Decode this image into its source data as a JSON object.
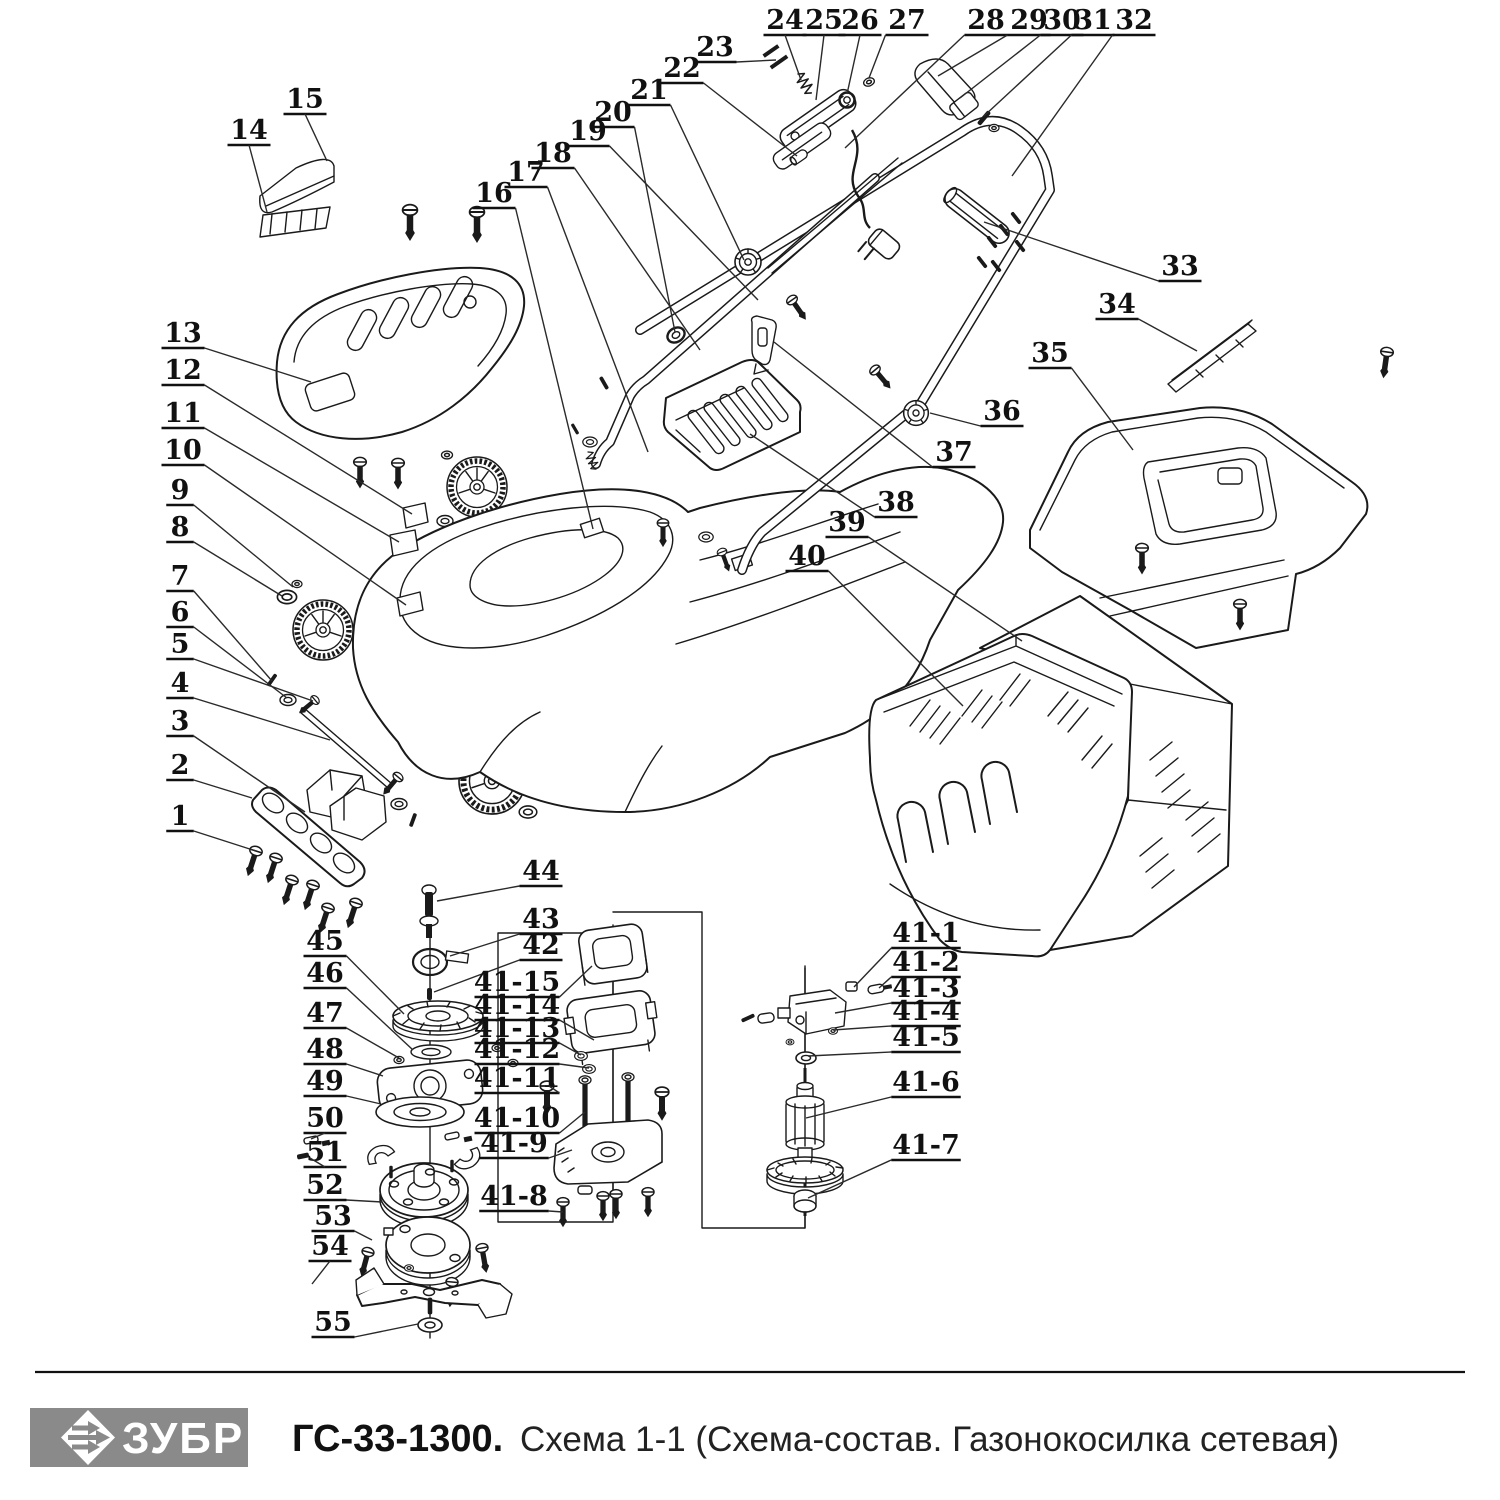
{
  "footer": {
    "brand": "ЗУБР",
    "model": "ГС-33-1300.",
    "title": "Схема 1-1 (Схема-состав. Газонокосилка сетевая)",
    "logo_bg": "#8a8a8a",
    "logo_text_color": "#ffffff"
  },
  "diagram": {
    "line_color": "#1a1a1a",
    "labels": [
      {
        "id": "1",
        "x": 180,
        "y": 816,
        "tx": 256,
        "ty": 851
      },
      {
        "id": "2",
        "x": 180,
        "y": 765,
        "tx": 252,
        "ty": 798
      },
      {
        "id": "3",
        "x": 180,
        "y": 721,
        "tx": 305,
        "ty": 812
      },
      {
        "id": "4",
        "x": 180,
        "y": 683,
        "tx": 330,
        "ty": 740
      },
      {
        "id": "5",
        "x": 180,
        "y": 644,
        "tx": 313,
        "ty": 701
      },
      {
        "id": "6",
        "x": 180,
        "y": 612,
        "tx": 287,
        "ty": 698
      },
      {
        "id": "7",
        "x": 180,
        "y": 576,
        "tx": 272,
        "ty": 681
      },
      {
        "id": "8",
        "x": 180,
        "y": 527,
        "tx": 282,
        "ty": 596
      },
      {
        "id": "9",
        "x": 180,
        "y": 490,
        "tx": 293,
        "ty": 587
      },
      {
        "id": "10",
        "x": 183,
        "y": 450,
        "tx": 406,
        "ty": 605
      },
      {
        "id": "11",
        "x": 183,
        "y": 413,
        "tx": 399,
        "ty": 542
      },
      {
        "id": "12",
        "x": 183,
        "y": 370,
        "tx": 412,
        "ty": 514
      },
      {
        "id": "13",
        "x": 183,
        "y": 333,
        "tx": 311,
        "ty": 382
      },
      {
        "id": "14",
        "x": 249,
        "y": 130,
        "tx": 267,
        "ty": 212
      },
      {
        "id": "15",
        "x": 305,
        "y": 99,
        "tx": 327,
        "ty": 161
      },
      {
        "id": "16",
        "x": 494,
        "y": 193,
        "tx": 593,
        "ty": 529
      },
      {
        "id": "17",
        "x": 526,
        "y": 172,
        "tx": 648,
        "ty": 452
      },
      {
        "id": "18",
        "x": 553,
        "y": 153,
        "tx": 700,
        "ty": 350
      },
      {
        "id": "19",
        "x": 588,
        "y": 131,
        "tx": 758,
        "ty": 300
      },
      {
        "id": "20",
        "x": 613,
        "y": 112,
        "tx": 675,
        "ty": 332
      },
      {
        "id": "21",
        "x": 649,
        "y": 90,
        "tx": 744,
        "ty": 260
      },
      {
        "id": "22",
        "x": 682,
        "y": 68,
        "tx": 797,
        "ty": 156
      },
      {
        "id": "23",
        "x": 715,
        "y": 47,
        "tx": 776,
        "ty": 60
      },
      {
        "id": "24",
        "x": 785,
        "y": 20,
        "tx": 801,
        "ty": 80
      },
      {
        "id": "25",
        "x": 824,
        "y": 20,
        "tx": 816,
        "ty": 100
      },
      {
        "id": "26",
        "x": 860,
        "y": 20,
        "tx": 847,
        "ty": 94
      },
      {
        "id": "27",
        "x": 907,
        "y": 20,
        "tx": 869,
        "ty": 78
      },
      {
        "id": "28",
        "x": 986,
        "y": 20,
        "tx": 845,
        "ty": 148
      },
      {
        "id": "29",
        "x": 1029,
        "y": 20,
        "tx": 938,
        "ty": 76
      },
      {
        "id": "30",
        "x": 1062,
        "y": 20,
        "tx": 960,
        "ty": 98
      },
      {
        "id": "31",
        "x": 1093,
        "y": 20,
        "tx": 984,
        "ty": 116
      },
      {
        "id": "32",
        "x": 1134,
        "y": 20,
        "tx": 1012,
        "ty": 176
      },
      {
        "id": "33",
        "x": 1180,
        "y": 266,
        "tx": 984,
        "ty": 222
      },
      {
        "id": "34",
        "x": 1117,
        "y": 304,
        "tx": 1197,
        "ty": 351
      },
      {
        "id": "35",
        "x": 1050,
        "y": 353,
        "tx": 1133,
        "ty": 450
      },
      {
        "id": "36",
        "x": 1002,
        "y": 411,
        "tx": 930,
        "ty": 413
      },
      {
        "id": "37",
        "x": 954,
        "y": 452,
        "tx": 774,
        "ty": 342
      },
      {
        "id": "38",
        "x": 896,
        "y": 502,
        "tx": 750,
        "ty": 434
      },
      {
        "id": "39",
        "x": 847,
        "y": 522,
        "tx": 1022,
        "ty": 641
      },
      {
        "id": "40",
        "x": 807,
        "y": 556,
        "tx": 963,
        "ty": 706
      },
      {
        "id": "44",
        "x": 541,
        "y": 871,
        "tx": 437,
        "ty": 901
      },
      {
        "id": "43",
        "x": 541,
        "y": 919,
        "tx": 450,
        "ty": 956
      },
      {
        "id": "42",
        "x": 541,
        "y": 945,
        "tx": 434,
        "ty": 992
      },
      {
        "id": "45",
        "x": 325,
        "y": 941,
        "tx": 404,
        "ty": 1014
      },
      {
        "id": "46",
        "x": 325,
        "y": 973,
        "tx": 413,
        "ty": 1050
      },
      {
        "id": "47",
        "x": 325,
        "y": 1013,
        "tx": 399,
        "ty": 1058
      },
      {
        "id": "48",
        "x": 325,
        "y": 1049,
        "tx": 383,
        "ty": 1076
      },
      {
        "id": "49",
        "x": 325,
        "y": 1081,
        "tx": 381,
        "ty": 1104
      },
      {
        "id": "50",
        "x": 325,
        "y": 1118,
        "tx": 311,
        "ty": 1139
      },
      {
        "id": "51",
        "x": 325,
        "y": 1152,
        "tx": 310,
        "ty": 1158
      },
      {
        "id": "52",
        "x": 325,
        "y": 1185,
        "tx": 382,
        "ty": 1202
      },
      {
        "id": "53",
        "x": 333,
        "y": 1216,
        "tx": 372,
        "ty": 1240
      },
      {
        "id": "54",
        "x": 330,
        "y": 1246,
        "tx": 312,
        "ty": 1284
      },
      {
        "id": "55",
        "x": 333,
        "y": 1322,
        "tx": 418,
        "ty": 1324
      },
      {
        "id": "41-15",
        "x": 517,
        "y": 982,
        "tx": 592,
        "ty": 966
      },
      {
        "id": "41-14",
        "x": 517,
        "y": 1005,
        "tx": 594,
        "ty": 1040
      },
      {
        "id": "41-13",
        "x": 517,
        "y": 1028,
        "tx": 581,
        "ty": 1055
      },
      {
        "id": "41-12",
        "x": 517,
        "y": 1049,
        "tx": 589,
        "ty": 1068
      },
      {
        "id": "41-11",
        "x": 517,
        "y": 1078,
        "tx": 549,
        "ty": 1086
      },
      {
        "id": "41-10",
        "x": 517,
        "y": 1118,
        "tx": 585,
        "ty": 1112
      },
      {
        "id": "41-9",
        "x": 514,
        "y": 1143,
        "tx": 572,
        "ty": 1150
      },
      {
        "id": "41-8",
        "x": 514,
        "y": 1196,
        "tx": 563,
        "ty": 1212
      },
      {
        "id": "41-1",
        "x": 926,
        "y": 933,
        "tx": 854,
        "ty": 987
      },
      {
        "id": "41-2",
        "x": 926,
        "y": 962,
        "tx": 879,
        "ty": 988
      },
      {
        "id": "41-3",
        "x": 926,
        "y": 988,
        "tx": 835,
        "ty": 1013
      },
      {
        "id": "41-4",
        "x": 926,
        "y": 1011,
        "tx": 833,
        "ty": 1030
      },
      {
        "id": "41-5",
        "x": 926,
        "y": 1037,
        "tx": 808,
        "ty": 1056
      },
      {
        "id": "41-6",
        "x": 926,
        "y": 1082,
        "tx": 806,
        "ty": 1118
      },
      {
        "id": "41-7",
        "x": 926,
        "y": 1145,
        "tx": 808,
        "ty": 1198
      }
    ]
  }
}
